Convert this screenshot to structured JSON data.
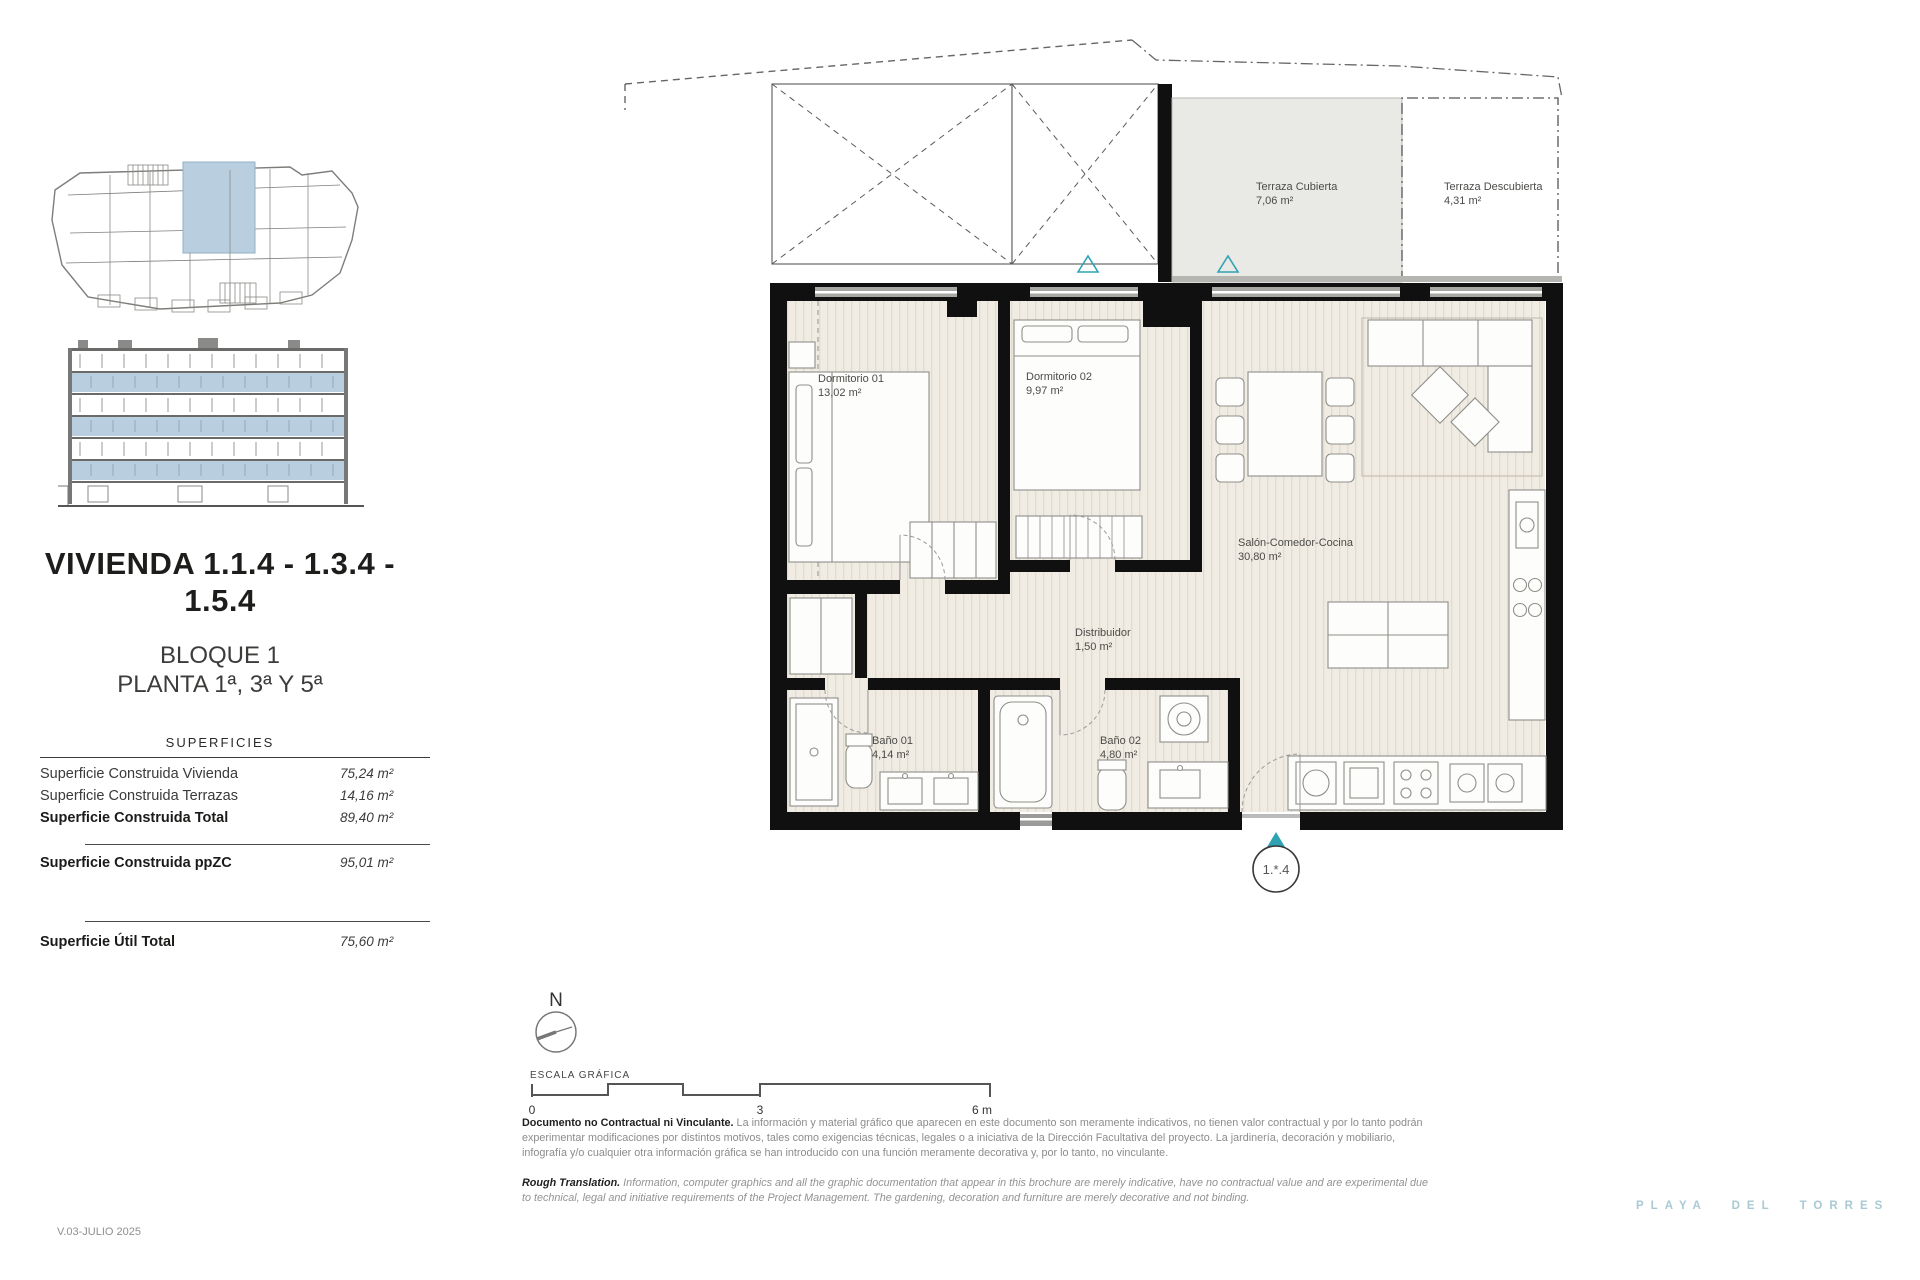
{
  "sidebar": {
    "title_line1": "VIVIENDA 1.1.4 - 1.3.4 -",
    "title_line2": "1.5.4",
    "block": "BLOQUE 1",
    "floor": "PLANTA 1ª, 3ª Y 5ª",
    "table": {
      "heading": "SUPERFICIES",
      "rows": [
        {
          "label": "Superficie Construida Vivienda",
          "value": "75,24 m²"
        },
        {
          "label": "Superficie Construida Terrazas",
          "value": "14,16 m²"
        },
        {
          "label": "Superficie Construida Total",
          "value": "89,40 m²"
        },
        {
          "label": "Superficie Construida ppZC",
          "value": "95,01 m²"
        },
        {
          "label": "Superficie Útil Total",
          "value": "75,60 m²"
        }
      ]
    }
  },
  "plan": {
    "rooms": [
      {
        "name": "Terraza Cubierta",
        "area": "7,06 m²"
      },
      {
        "name": "Terraza Descubierta",
        "area": "4,31 m²"
      },
      {
        "name": "Dormitorio 01",
        "area": "13,02 m²"
      },
      {
        "name": "Dormitorio 02",
        "area": "9,97 m²"
      },
      {
        "name": "Salón-Comedor-Cocina",
        "area": "30,80 m²"
      },
      {
        "name": "Distribuidor",
        "area": "1,50 m²"
      },
      {
        "name": "Baño 01",
        "area": "4,14 m²"
      },
      {
        "name": "Baño 02",
        "area": "4,80 m²"
      }
    ],
    "unit_marker": "1.*.4",
    "north_label": "N",
    "scale": {
      "label": "ESCALA GRÁFICA",
      "ticks": [
        "0",
        "3",
        "6 m"
      ]
    }
  },
  "disclaimer": {
    "es_bold": "Documento no Contractual ni Vinculante.",
    "es_text": " La información y material gráfico que aparecen en este documento son meramente indicativos, no tienen valor contractual y por lo tanto podrán experimentar modificaciones por distintos motivos, tales como exigencias técnicas, legales o a iniciativa de la Dirección Facultativa del proyecto. La jardinería, decoración y mobiliario, infografía y/o cualquier otra información gráfica se han introducido con una función meramente decorativa y, por lo tanto, no vinculante.",
    "en_bold": "Rough Translation.",
    "en_text": " Information, computer graphics and all the graphic documentation that appear in this brochure are merely indicative, have no contractual value and are experimental due to technical, legal and initiative requirements of the Project Management. The gardening, decoration and furniture are merely decorative and not binding."
  },
  "footer": {
    "version": "V.03-JULIO 2025",
    "brand": "PLAYA DEL TORRES"
  },
  "colors": {
    "highlight_blue": "#b9cfdf",
    "teal": "#2fa3b3",
    "brand_blue": "#a9c9d3",
    "wall_black": "#101010",
    "floor_beige": "#f1ece3",
    "terrace_gray": "#e9e9e6"
  }
}
